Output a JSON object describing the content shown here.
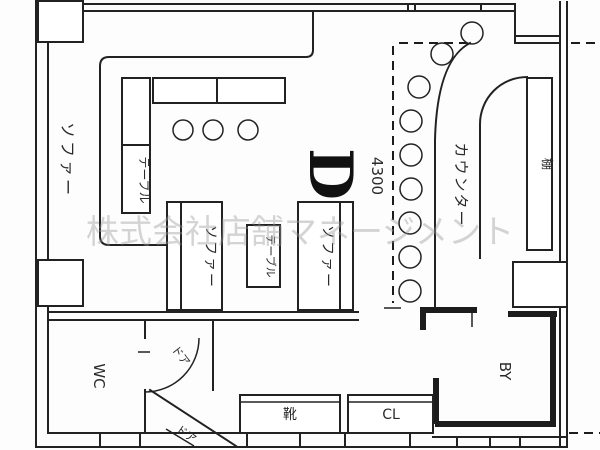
{
  "watermark": "株式会社店舗マネージメント",
  "colors": {
    "line": "#222222",
    "background": "#ffffff",
    "watermark": "#9a9a9a"
  },
  "plan": {
    "dimension_label": "4300",
    "zone_marker": "D",
    "labels": {
      "sofa_left": "ソファー",
      "table_corner": "テーブル",
      "sofa_mid_left": "ソファー",
      "table_mid": "テーブル",
      "sofa_mid_right": "ソファー",
      "counter": "カウンター",
      "shelf": "棚",
      "wc": "WC",
      "backyard": "BY",
      "shoes": "靴",
      "closet": "CL",
      "door_wc": "ドア",
      "door_entry": "ドア"
    }
  }
}
